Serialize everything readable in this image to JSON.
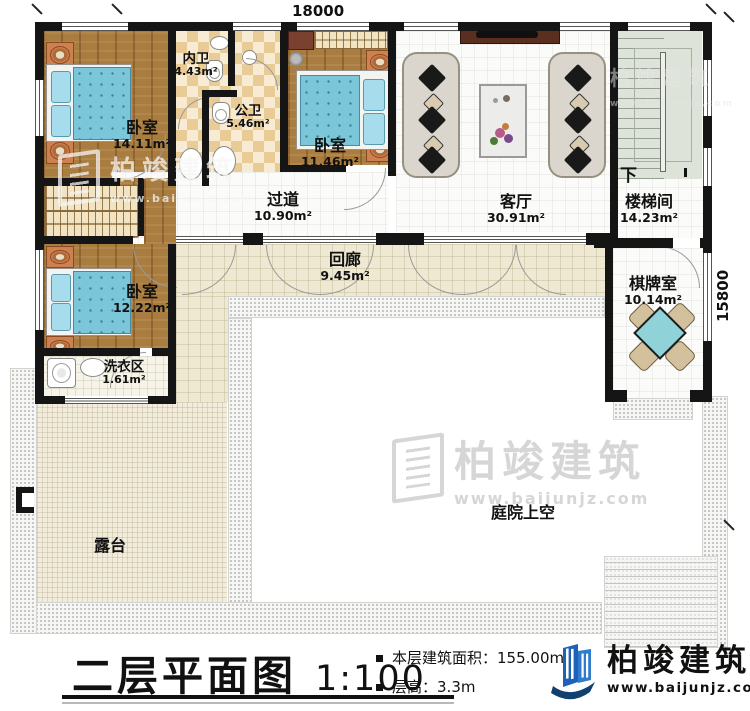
{
  "title_block": {
    "plan_title": "二层平面图",
    "scale": "1:100",
    "area_label": "本层建筑面积：",
    "area_value": "155.00m²",
    "floor_height_label": "层高：",
    "floor_height_value": "3.3m"
  },
  "brand": {
    "name": "柏竣建筑",
    "website": "www.baijunjz.com"
  },
  "watermark": {
    "name": "柏竣建筑",
    "website": "www.baijunjz.com"
  },
  "dimensions": {
    "top": "18000",
    "right": "15800"
  },
  "stairs": {
    "direction_label": "下"
  },
  "rooms": {
    "bedroom1": {
      "name": "卧室",
      "area": "14.11m²"
    },
    "inner_bath": {
      "name": "内卫",
      "area": "4.43m²"
    },
    "public_bath": {
      "name": "公卫",
      "area": "5.46m²"
    },
    "bedroom2": {
      "name": "卧室",
      "area": "11.46m²"
    },
    "living_room": {
      "name": "客厅",
      "area": "30.91m²"
    },
    "stair_hall": {
      "name": "楼梯间",
      "area": "14.23m²"
    },
    "hallway": {
      "name": "过道",
      "area": "10.90m²"
    },
    "gallery": {
      "name": "回廊",
      "area": "9.45m²"
    },
    "bedroom3": {
      "name": "卧室",
      "area": "12.22m²"
    },
    "laundry": {
      "name": "洗衣区",
      "area": "1.61m²"
    },
    "chess_room": {
      "name": "棋牌室",
      "area": "10.14m²"
    },
    "terrace": {
      "name": "露台"
    },
    "courtyard": {
      "name": "庭院上空"
    }
  },
  "colors": {
    "wall": "#151515",
    "wood_floor": "#a97c40",
    "bed_teal": "#7cc6da",
    "bath_tile_tan": "#e9cb96",
    "corridor_beige": "#efe9d3",
    "stairs_sage": "#dde3d8",
    "chess_table_teal": "#8fd2d8",
    "brand_blue": "#1b62b8",
    "brand_navy": "#11406f"
  }
}
